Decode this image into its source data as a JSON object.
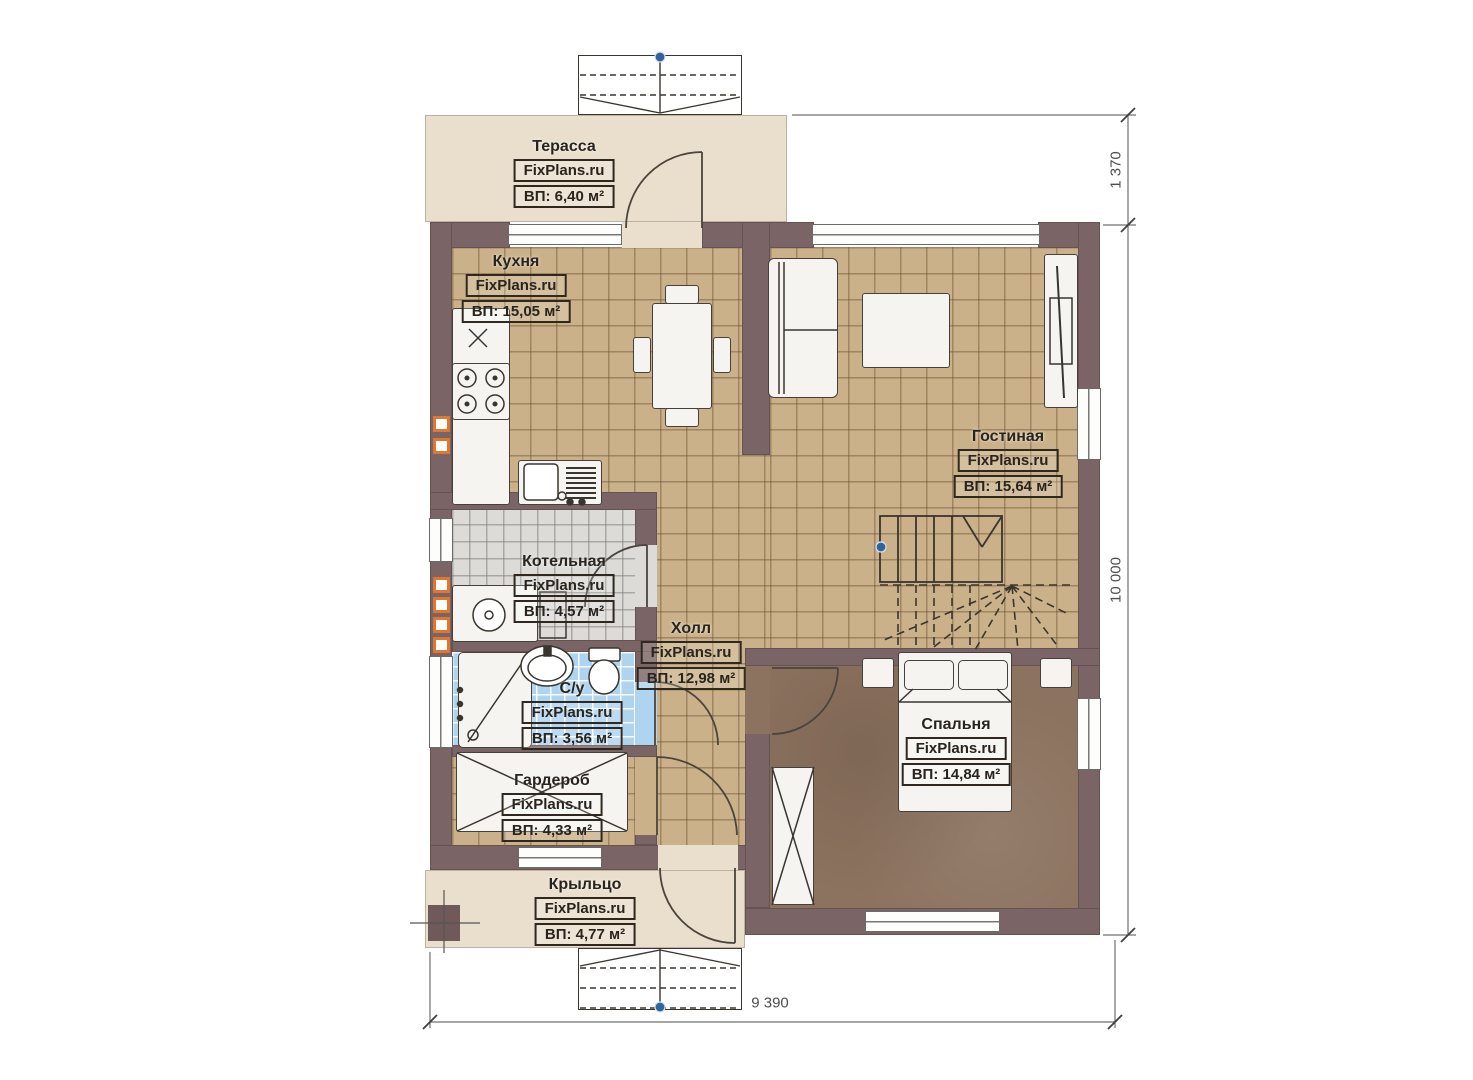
{
  "brand": "FixPlans.ru",
  "rooms": [
    {
      "id": "terrace",
      "name": "Терасса",
      "area": "ВП: 6,40 м²"
    },
    {
      "id": "kitchen",
      "name": "Кухня",
      "area": "ВП: 15,05 м²"
    },
    {
      "id": "living",
      "name": "Гостиная",
      "area": "ВП: 15,64 м²"
    },
    {
      "id": "boiler",
      "name": "Котельная",
      "area": "ВП: 4,57 м²"
    },
    {
      "id": "hall",
      "name": "Холл",
      "area": "ВП: 12,98 м²"
    },
    {
      "id": "bathroom",
      "name": "С/у",
      "area": "ВП: 3,56 м²"
    },
    {
      "id": "bedroom",
      "name": "Спальня",
      "area": "ВП: 14,84 м²"
    },
    {
      "id": "wardrobe",
      "name": "Гардероб",
      "area": "ВП: 4,33 м²"
    },
    {
      "id": "porch",
      "name": "Крыльцо",
      "area": "ВП: 4,77 м²"
    }
  ],
  "dims": {
    "terrace_depth": "1 370",
    "house_height": "10 000",
    "house_width": "9 390"
  },
  "colors": {
    "wall": "#7b6466",
    "floor_tile": "#cbb189",
    "floor_boiler": "#dcdbd8",
    "floor_bath": "#aed4ef",
    "floor_bedroom": "#8c7360",
    "terrace": "#e9dfcc",
    "vent_accent": "#e0762f",
    "marker_blue": "#31639c"
  }
}
